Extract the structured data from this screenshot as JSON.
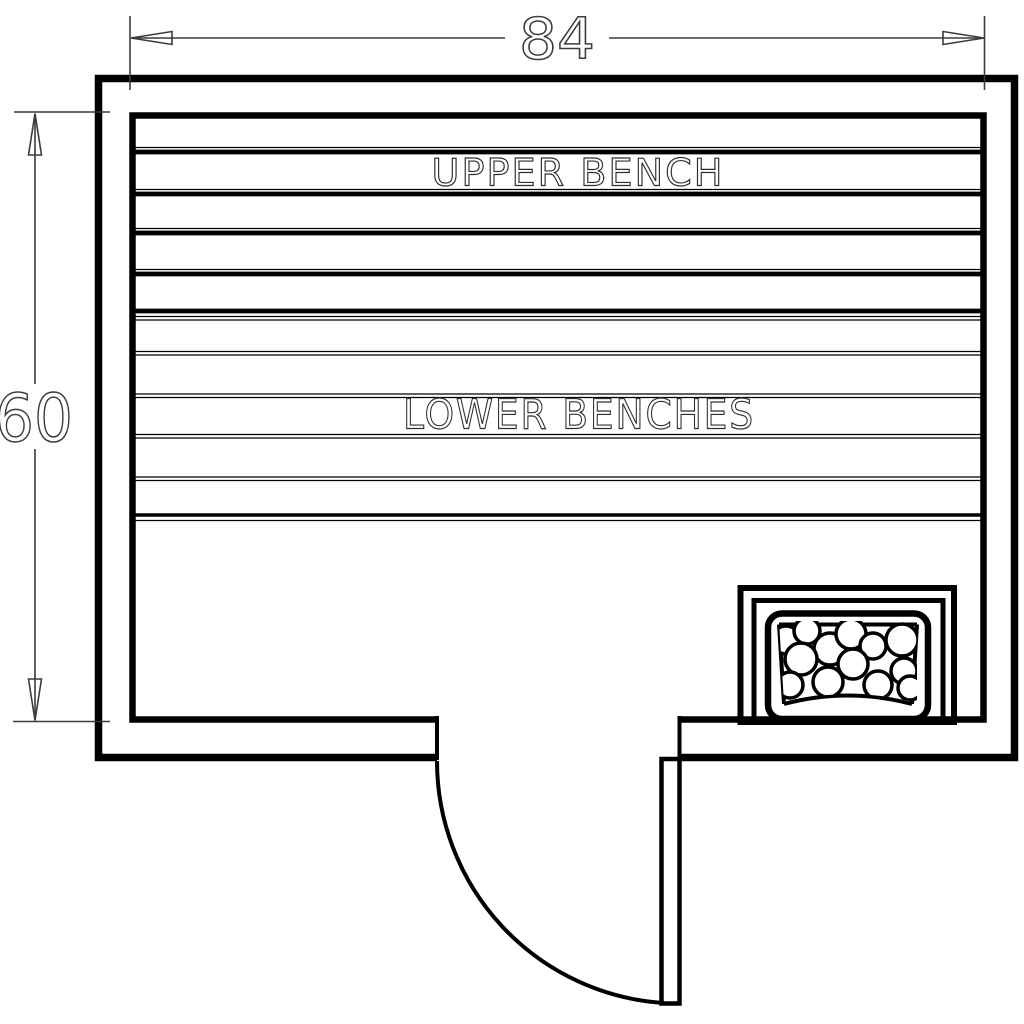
{
  "drawing": {
    "type": "sauna-floor-plan",
    "dimensions": {
      "top_label": "84",
      "left_label": "60"
    },
    "labels": {
      "upper_bench": "UPPER BENCH",
      "lower_benches": "LOWER BENCHES"
    },
    "colors": {
      "wall": "#000000",
      "bench": "#000000",
      "heater": "#000000",
      "door": "#000000",
      "dimension": "#3c3c3c",
      "text": "#2e2e2e",
      "background": "#ffffff"
    }
  }
}
